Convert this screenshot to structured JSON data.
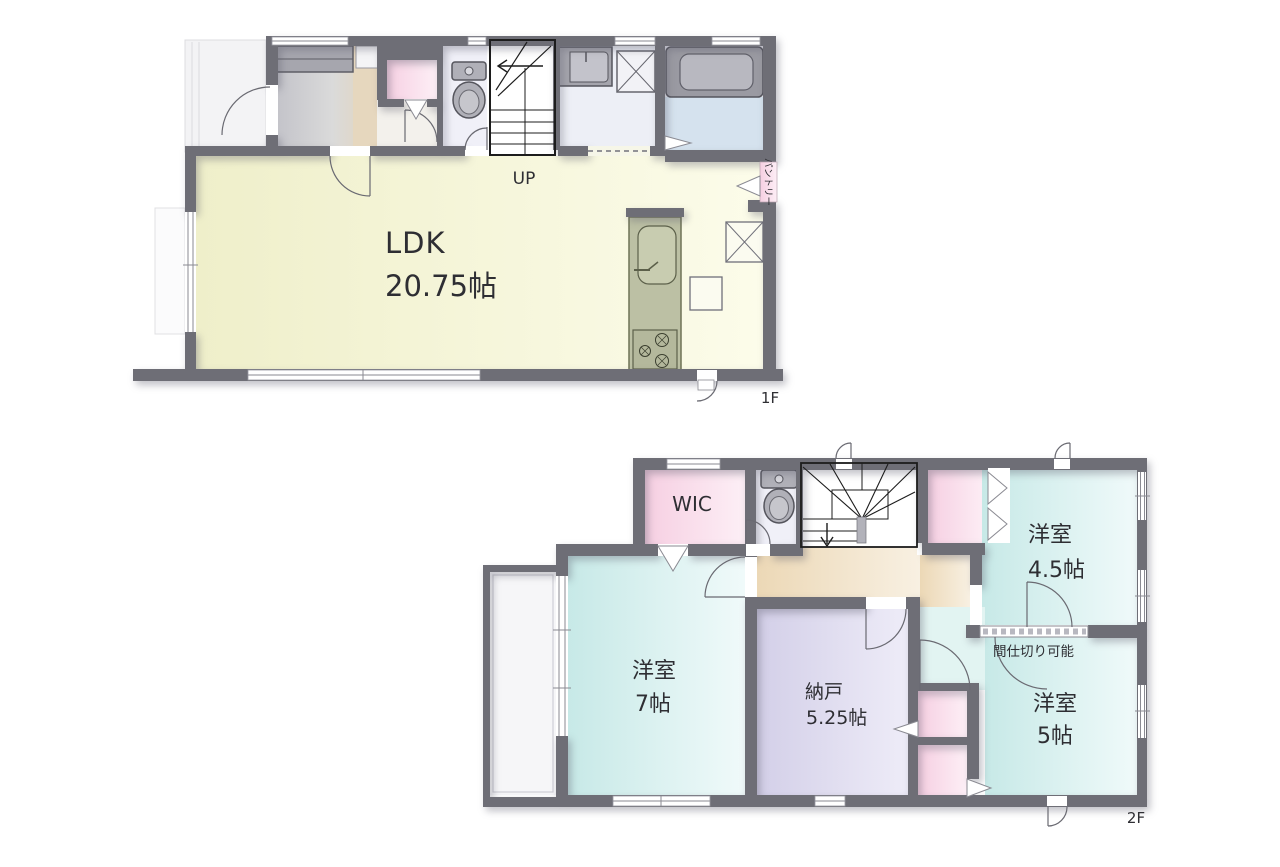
{
  "floorplan": {
    "floor1": {
      "floor_label": "1F",
      "ldk": {
        "name": "LDK",
        "size": "20.75帖"
      },
      "stairs_label": "UP",
      "pantry_label": "パントリー"
    },
    "floor2": {
      "floor_label": "2F",
      "wic_label": "WIC",
      "bedroom_main": {
        "name": "洋室",
        "size": "7帖"
      },
      "bedroom_east": {
        "name": "洋室",
        "size": "4.5帖"
      },
      "bedroom_south": {
        "name": "洋室",
        "size": "5帖"
      },
      "storage": {
        "name": "納戸",
        "size": "5.25帖"
      },
      "partition_note": "間仕切り可能"
    },
    "colors": {
      "wall": "#6e6e76",
      "ldk_floor": "#f1f1ce",
      "bedroom_floor": "#cdecea",
      "storage_floor": "#d5d1e9",
      "closet_pink": "#f6d1e3",
      "hall_tan": "#ecd9b8",
      "bath_floor": "#d5e2ee",
      "genkan_gray": "#c4c4ca",
      "fixture_gray": "#a8a8b0",
      "kitchen_counter": "#bcc0a4"
    }
  }
}
